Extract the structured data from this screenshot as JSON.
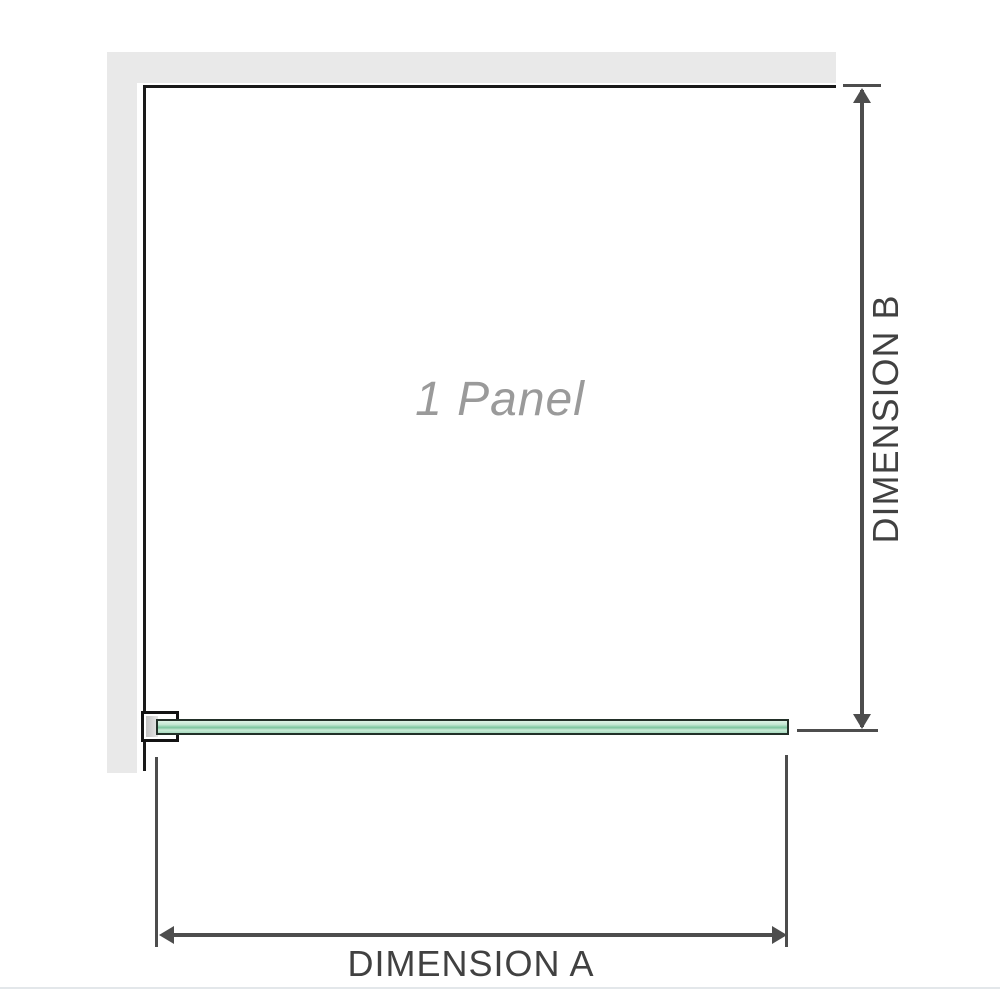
{
  "diagram": {
    "title": "shower-screen-panel-dimension-diagram",
    "panel_label": "1 Panel",
    "dimension_a_label": "DIMENSION A",
    "dimension_b_label": "DIMENSION B",
    "parts": {
      "wall": "L-shaped wall shown top and left",
      "glass_panel": "single fixed glass panel along bottom, mounted to wall with a clamp bracket",
      "dimension_a": "horizontal width of the glass panel, measured at bottom",
      "dimension_b": "vertical height of the panel opening, measured at right"
    }
  },
  "colors": {
    "wall": "#e9e9e9",
    "frame": "#1a1a1a",
    "dim": "#4d4d4d",
    "text": "#414141",
    "panel_text": "#9a9a9a",
    "glass_fill": "#a9dcc0",
    "glass_edge": "#223028",
    "divider": "#e3e7ea"
  }
}
